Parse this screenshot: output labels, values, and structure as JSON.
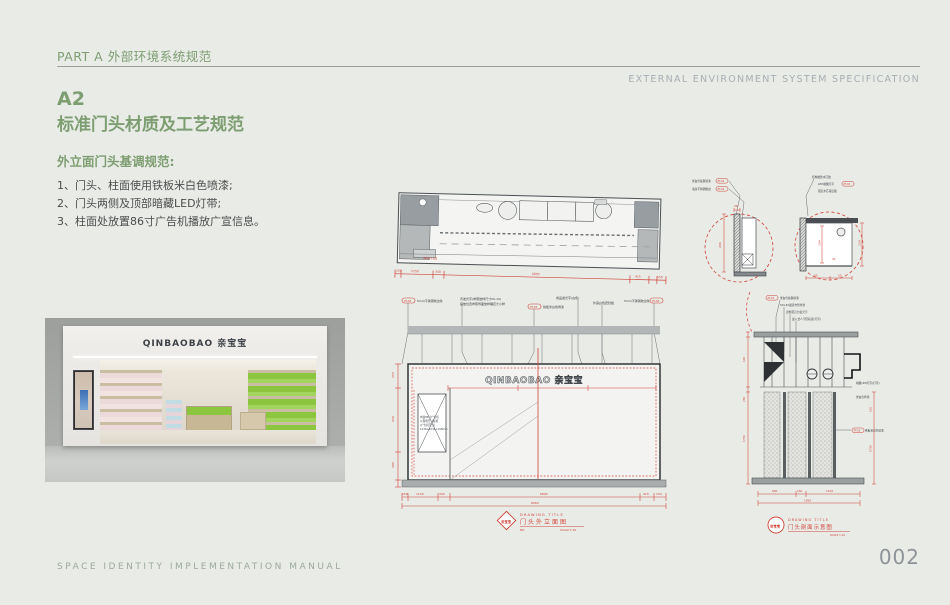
{
  "header": {
    "part_label": "PART A 外部环境系统规范",
    "spec_en": "EXTERNAL ENVIRONMENT SYSTEM SPECIFICATION"
  },
  "title": {
    "code": "A2",
    "name": "标准门头材质及工艺规范"
  },
  "intro": {
    "heading": "外立面门头基调规范:",
    "items": [
      "1、门头、柱面使用铁板米白色喷漆;",
      "2、门头两侧及顶部暗藏LED灯带;",
      "3、柱面处放置86寸广告机播放广宣信息。"
    ]
  },
  "footer": {
    "left": "SPACE IDENTITY IMPLEMENTATION MANUAL",
    "page": "002"
  },
  "photo": {
    "sign": "QINBAOBAO 亲宝宝"
  },
  "plan": {
    "floor_note": "MW-100",
    "dims": [
      "150",
      "1150",
      "340",
      "6805",
      "415",
      "150"
    ]
  },
  "elevation": {
    "logo": "QINBAOBAO 亲宝宝",
    "ann": [
      {
        "tag": "PT-03",
        "text": "5mm不锈钢收边条"
      },
      {
        "tag": "",
        "text": "背发光字(参照放样尺寸50-10)"
      },
      {
        "tag": "",
        "text": "摆放位置参照饰面放样确定大小样"
      },
      {
        "tag": "PT-03",
        "text": "铁板米白色烤漆"
      },
      {
        "tag": "",
        "text": "成品发光字(白色)"
      },
      {
        "tag": "",
        "text": "外露白色密封胶"
      },
      {
        "tag": "PT-03",
        "text": "5mm不锈钢收边条"
      }
    ],
    "ad_note": [
      "内嵌86寸广告机",
      "以现场尺寸复核",
      "(广告机尺寸)",
      "1236×2234×108mm"
    ],
    "dims_left": [
      "250",
      "640",
      "280"
    ],
    "dims_bottom": [
      "150",
      "1150",
      "340",
      "6805",
      "415",
      "150"
    ],
    "dim_total": "8960",
    "title_en": "DRAWING TITLE",
    "title_cn": "门头外立面图",
    "no_label": "NO.",
    "scale": "SCALE 1:30",
    "stamp": "亲宝宝"
  },
  "details": {
    "left": {
      "ann": [
        {
          "text": "米白色氟碳喷漆",
          "tag": "PT-03"
        },
        {
          "text": "墙身不锈钢收边",
          "tag": "PT-03"
        }
      ],
      "dim_top": "26",
      "dim_side": "200"
    },
    "right": {
      "ann": [
        {
          "text": "结构胶防水打胶",
          "tag": ""
        },
        {
          "text": "LED暗藏灯带",
          "tag": "PT-03"
        },
        {
          "text": "固定木芯基层板",
          "tag": ""
        }
      ],
      "dim_h1": "104",
      "dim_h2": "120",
      "dim_b1": "65",
      "dim_b2": "55",
      "dim_inner": "41"
    }
  },
  "section": {
    "ann_top": [
      {
        "tag": "PT-03",
        "text": "米白色氟碳喷漆"
      },
      {
        "tag": "",
        "text": "50×40镀锌方管骨架"
      },
      {
        "tag": "",
        "text": "定制亚克力发光字"
      },
      {
        "tag": "",
        "text": "嵌入式人字形轨道(灯带)"
      }
    ],
    "ann_right": [
      {
        "tag": "",
        "text": "暗藏LED灯带(灯带)"
      },
      {
        "tag": "",
        "text": "米白色烤漆"
      },
      {
        "tag": "PT-03",
        "text": "铁板米白色喷漆"
      }
    ],
    "dims_left": [
      "100",
      "250",
      "1750"
    ],
    "dims_right": [
      "120",
      "1750"
    ],
    "dims_bottom": [
      "600",
      "150",
      "1100"
    ],
    "dim_total": "1950",
    "title_en": "DRAWING TITLE",
    "title_cn": "门头剖面示意图",
    "scale": "SCALE 1:10",
    "stamp": "亲宝宝"
  }
}
